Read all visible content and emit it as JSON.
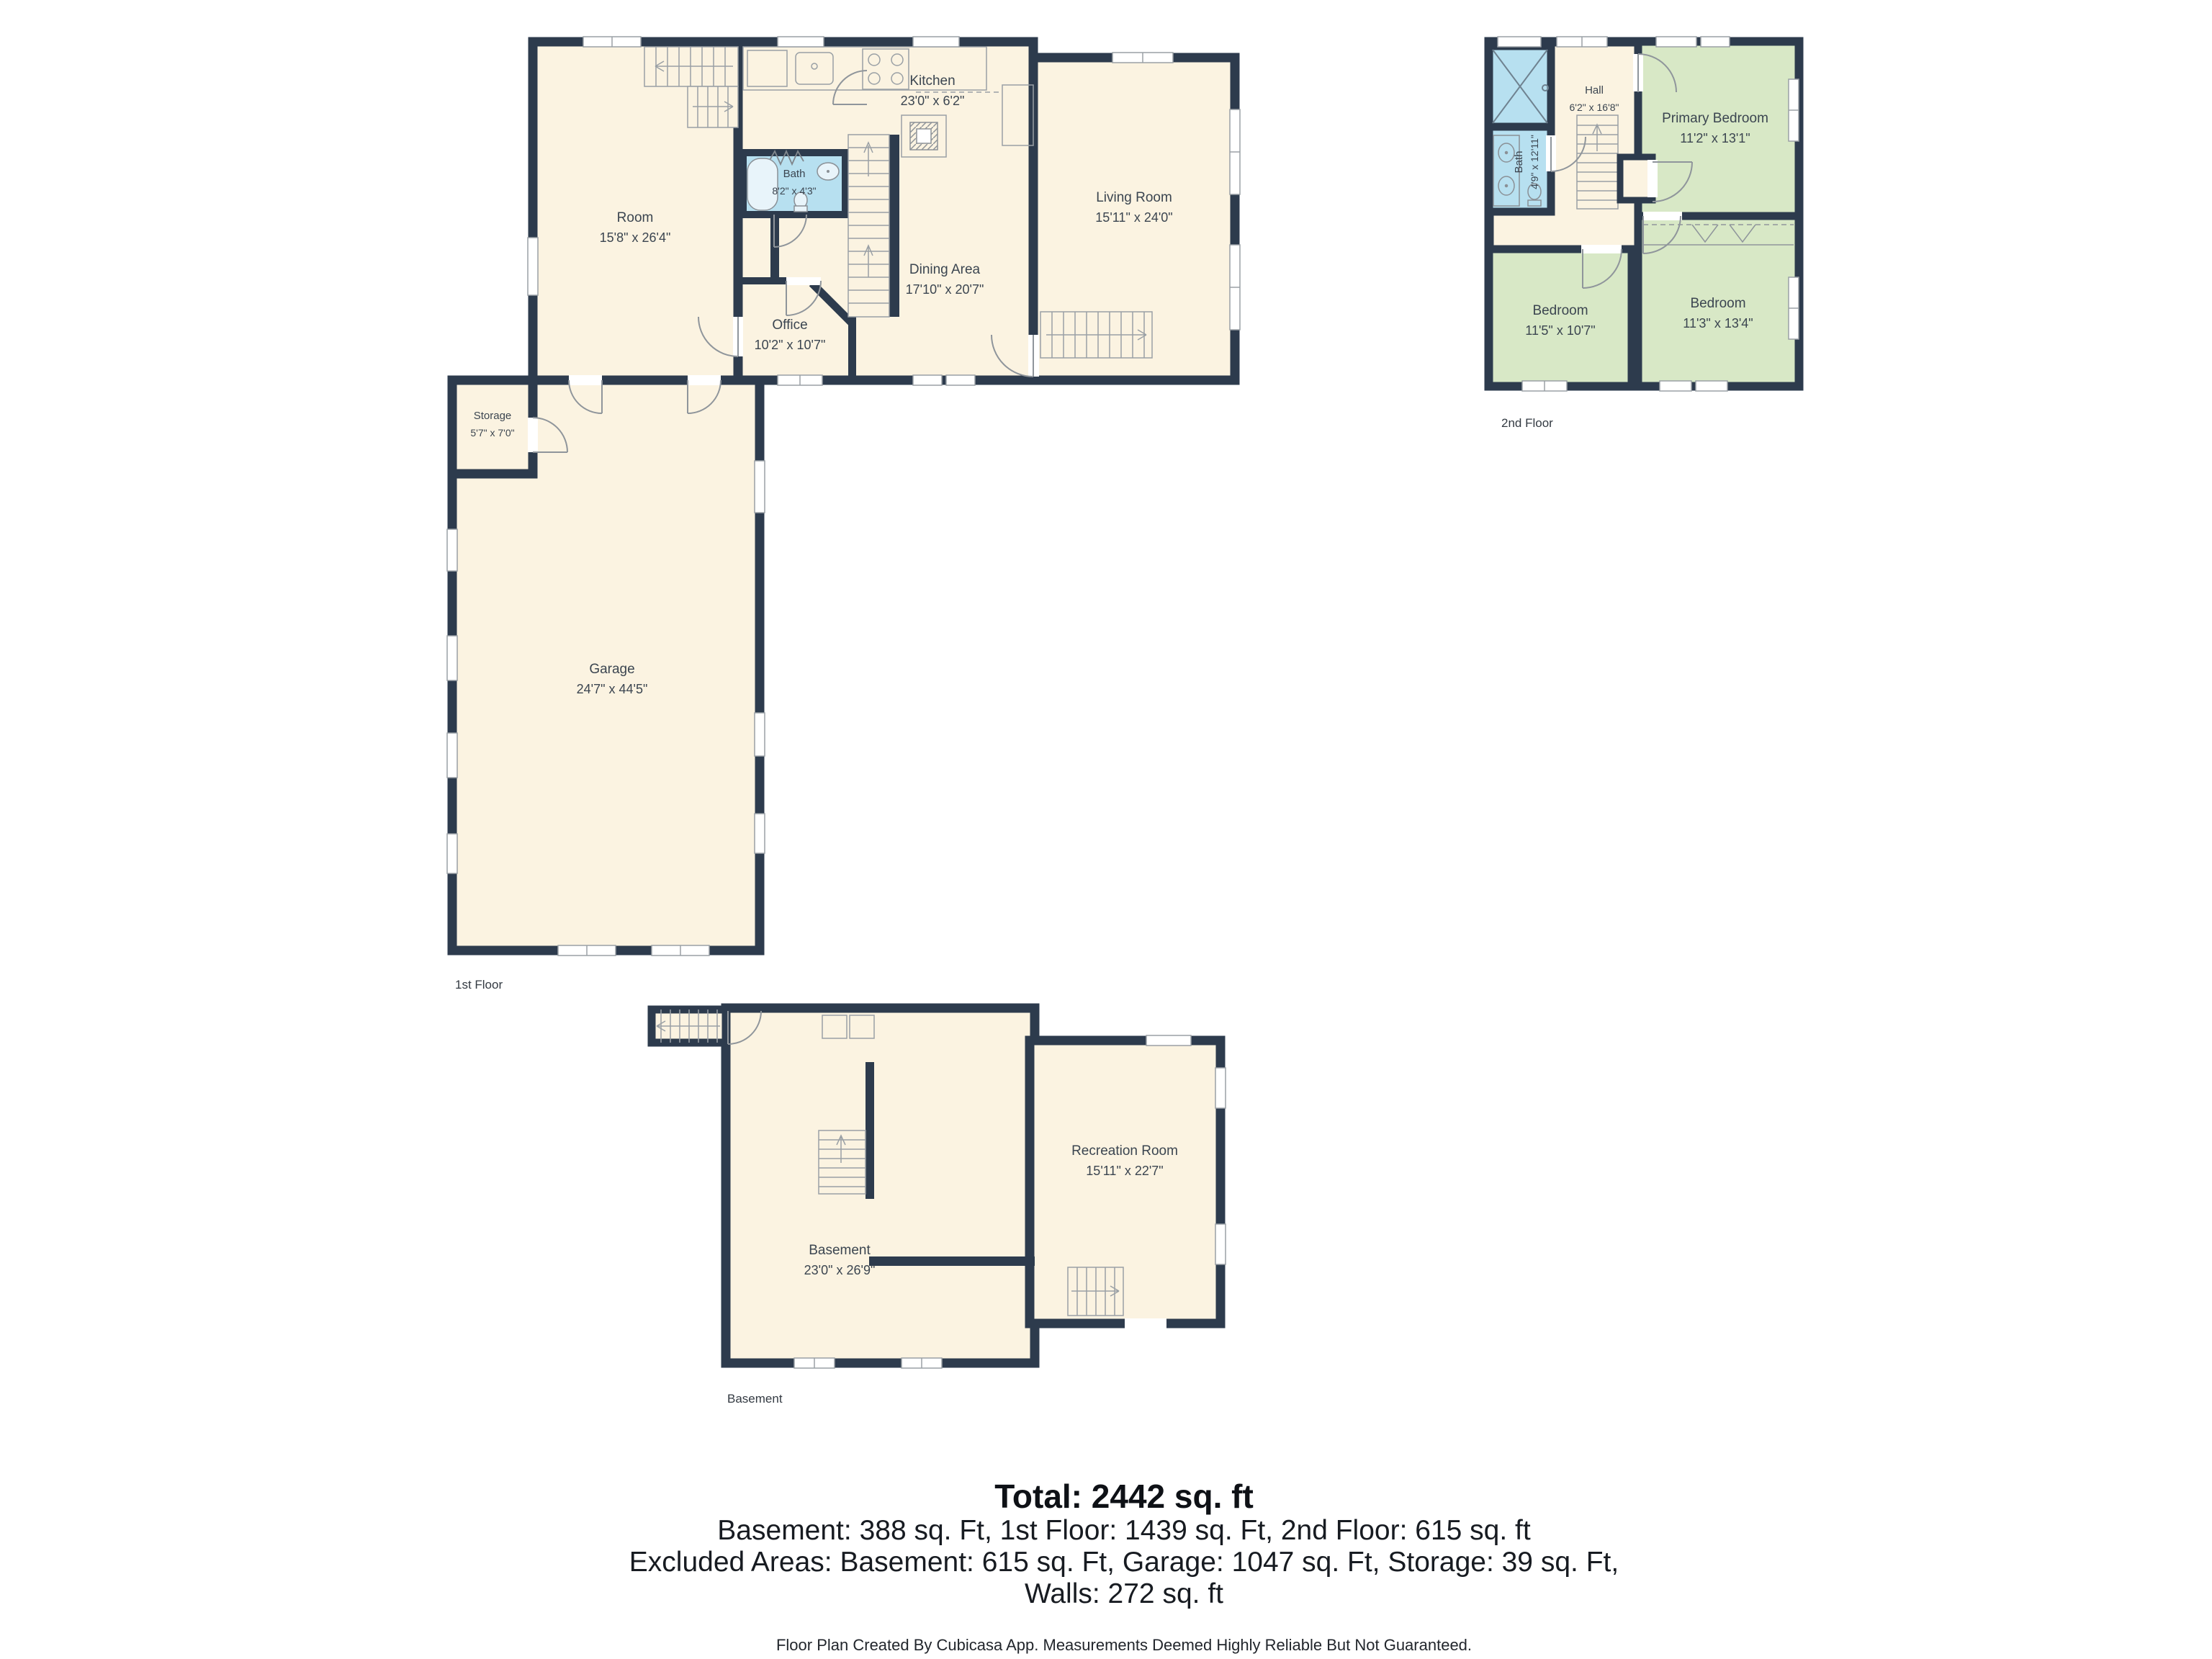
{
  "floors": {
    "first": {
      "label": "1st Floor",
      "rooms": [
        {
          "name": "Room",
          "dims": "15'8\" x 26'4\""
        },
        {
          "name": "Kitchen",
          "dims": "23'0\" x 6'2\""
        },
        {
          "name": "Bath",
          "dims": "8'2\" x 4'3\""
        },
        {
          "name": "Office",
          "dims": "10'2\" x 10'7\""
        },
        {
          "name": "Dining Area",
          "dims": "17'10\" x 20'7\""
        },
        {
          "name": "Living Room",
          "dims": "15'11\" x 24'0\""
        },
        {
          "name": "Storage",
          "dims": "5'7\" x 7'0\""
        },
        {
          "name": "Garage",
          "dims": "24'7\" x 44'5\""
        }
      ]
    },
    "second": {
      "label": "2nd Floor",
      "rooms": [
        {
          "name": "Hall",
          "dims": "6'2\" x 16'8\""
        },
        {
          "name": "Bath",
          "dims": "4'9\" x 12'11\""
        },
        {
          "name": "Primary Bedroom",
          "dims": "11'2\" x 13'1\""
        },
        {
          "name": "Bedroom",
          "dims": "11'5\" x 10'7\""
        },
        {
          "name": "Bedroom",
          "dims": "11'3\" x 13'4\""
        }
      ]
    },
    "basement": {
      "label": "Basement",
      "rooms": [
        {
          "name": "Basement",
          "dims": "23'0\" x 26'9\""
        },
        {
          "name": "Recreation Room",
          "dims": "15'11\" x 22'7\""
        }
      ]
    }
  },
  "summary": {
    "total": "Total: 2442 sq. ft",
    "line1": "Basement: 388 sq. Ft, 1st Floor: 1439 sq. Ft, 2nd Floor: 615 sq. ft",
    "line2": "Excluded Areas: Basement: 615 sq. Ft, Garage: 1047 sq. Ft, Storage: 39 sq. Ft,",
    "line3": "Walls: 272 sq. ft"
  },
  "footer": "Floor Plan Created By Cubicasa App. Measurements Deemed Highly Reliable But Not Guaranteed.",
  "colors": {
    "wall": "#2d3b4d",
    "floor": "#fbf3e1",
    "wet_room": "#b7e0f0",
    "bedroom": "#d8e8c6",
    "background": "#ffffff"
  }
}
